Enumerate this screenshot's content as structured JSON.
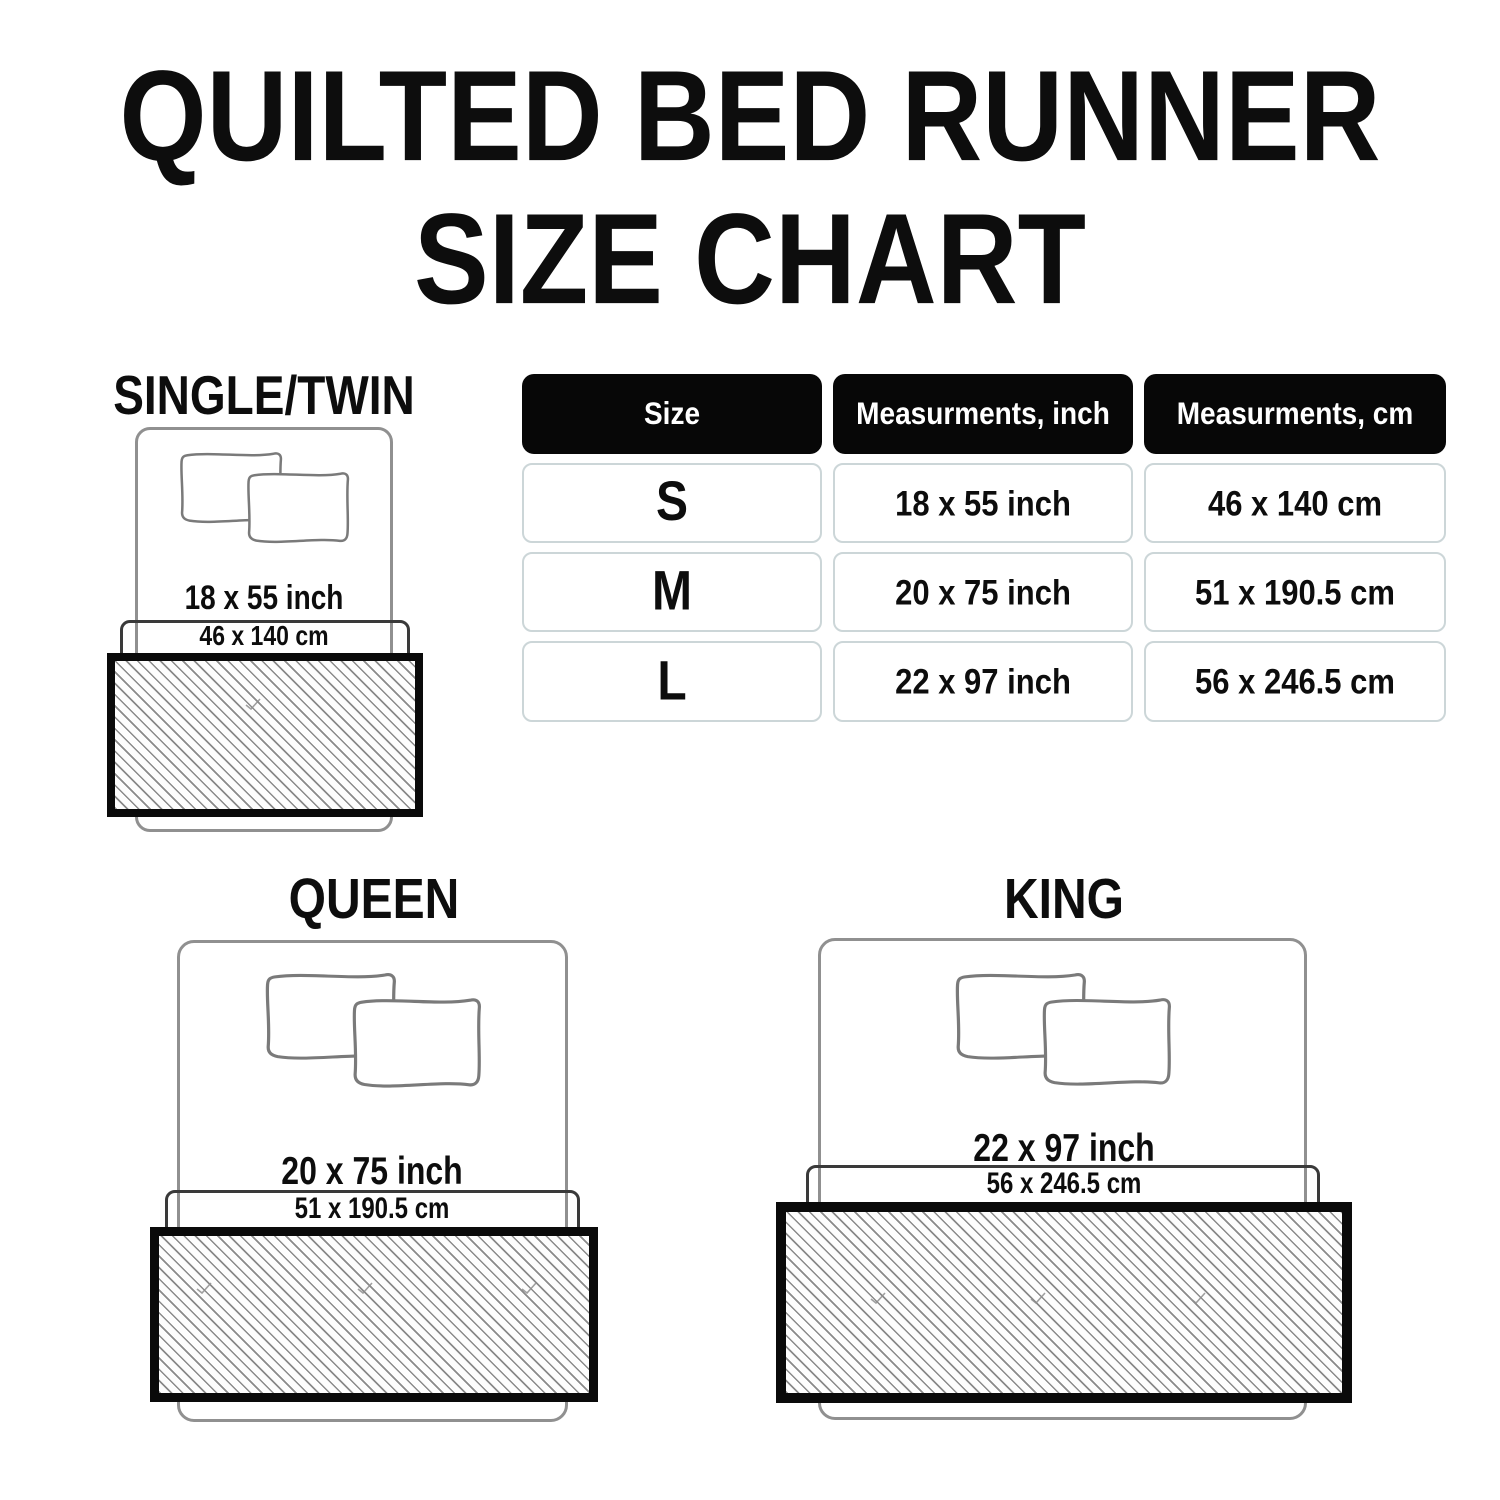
{
  "title": {
    "line1": "QUILTED BED RUNNER",
    "line2": "SIZE CHART"
  },
  "table": {
    "headers": [
      "Size",
      "Measurments, inch",
      "Measurments, cm"
    ],
    "rows": [
      {
        "size": "S",
        "inch": "18 x 55 inch",
        "cm": "46 x 140 cm"
      },
      {
        "size": "M",
        "inch": "20 x 75 inch",
        "cm": "51 x 190.5 cm"
      },
      {
        "size": "L",
        "inch": "22 x 97 inch",
        "cm": "56 x 246.5 cm"
      }
    ]
  },
  "diagrams": [
    {
      "label": "SINGLE/TWIN",
      "inch": "18 x 55 inch",
      "cm": "46 x 140 cm"
    },
    {
      "label": "QUEEN",
      "inch": "20 x 75 inch",
      "cm": "51 x 190.5 cm"
    },
    {
      "label": "KING",
      "inch": "22 x 97 inch",
      "cm": "56 x 246.5 cm"
    }
  ],
  "colors": {
    "text": "#0d0d0d",
    "table_header_bg": "#070707",
    "table_cell_border": "#ccd6d8",
    "bed_outline": "#909090",
    "sheet_outline": "#3a3a3a",
    "runner_border": "#0a0a0a",
    "hatch_line": "#8a8a8a"
  }
}
